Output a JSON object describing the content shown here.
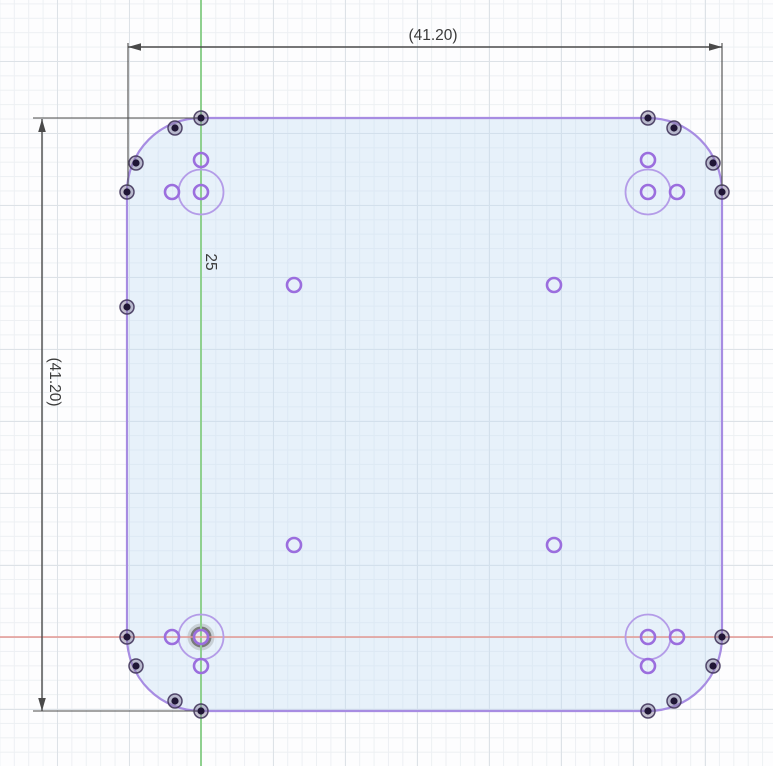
{
  "view": {
    "name": "CAD sketch viewport",
    "width_px": 773,
    "height_px": 766
  },
  "dimensions": {
    "width_label": "(41.20)",
    "height_label": "(41.20)",
    "offset_label": "25"
  },
  "colors": {
    "plate_fill": "rgba(198,223,245,0.40)",
    "plate_stroke": "#a78ce2",
    "hole_stroke": "#9b6ede",
    "bolt_circle_stroke": "#b49ce8",
    "axis_vertical": "#8fd08f",
    "axis_horizontal": "#e39792",
    "dimension": "#4a4a4a",
    "text": "#3b3b3b",
    "point_core": "#201636"
  },
  "geometry": {
    "plate_path": "M201,118 L648,118 A74,74 0 0 1 722,192 L722,637 A74,74 0 0 1 648,711 L201,711 A74,74 0 0 1 127,637 L127,192 A74,74 0 0 1 201,118 Z",
    "axes": {
      "vertical_x": 201,
      "horizontal_y": 637
    },
    "origin": {
      "x": 201,
      "y": 637
    },
    "bolt_circle_radius": 22.5,
    "bolt_circles": [
      [
        201,
        192
      ],
      [
        648,
        192
      ],
      [
        201,
        637
      ],
      [
        648,
        637
      ]
    ],
    "hole_radius": 7,
    "holes": [
      [
        201,
        160
      ],
      [
        172,
        192
      ],
      [
        201,
        192
      ],
      [
        648,
        160
      ],
      [
        677,
        192
      ],
      [
        648,
        192
      ],
      [
        172,
        637
      ],
      [
        201,
        637
      ],
      [
        201,
        666
      ],
      [
        677,
        637
      ],
      [
        648,
        637
      ],
      [
        648,
        666
      ],
      [
        294,
        285
      ],
      [
        554,
        285
      ],
      [
        294,
        545
      ],
      [
        554,
        545
      ]
    ],
    "points": [
      [
        201,
        118
      ],
      [
        175,
        128
      ],
      [
        136,
        163
      ],
      [
        127,
        192
      ],
      [
        648,
        118
      ],
      [
        674,
        128
      ],
      [
        713,
        163
      ],
      [
        722,
        192
      ],
      [
        127,
        307
      ],
      [
        127,
        637
      ],
      [
        136,
        666
      ],
      [
        175,
        701
      ],
      [
        201,
        711
      ],
      [
        722,
        637
      ],
      [
        713,
        666
      ],
      [
        674,
        701
      ],
      [
        648,
        711
      ]
    ]
  }
}
